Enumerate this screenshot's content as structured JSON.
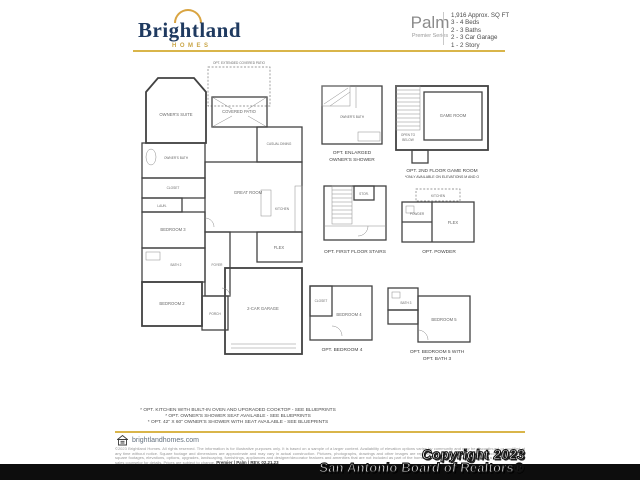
{
  "brand": {
    "name": "Brightland",
    "sub": "HOMES",
    "url": "brightlandhomes.com",
    "gold": "#D9B54A",
    "navy": "#1F3A60"
  },
  "header": {
    "plan_name": "Palm",
    "series": "Premier Series",
    "specs": [
      "1,916 Approx. SQ FT",
      "3 - 4 Beds",
      "2 - 3 Baths",
      "2 - 3 Car Garage",
      "1 - 2 Story"
    ]
  },
  "floorplan": {
    "main": {
      "ext_patio": "OPT. EXTENDED COVERED PATIO",
      "covered_patio": "COVERED PATIO",
      "owners_suite": "OWNER'S SUITE",
      "owners_bath": "OWNER'S BATH",
      "closet": "CLOSET",
      "laundry": "LAUN.",
      "casual_dining": "CASUAL DINING",
      "great_room": "GREAT ROOM",
      "kitchen": "KITCHEN",
      "bedroom3": "BEDROOM 3",
      "bath2": "BATH 2",
      "bedroom2": "BEDROOM 2",
      "foyer": "FOYER",
      "porch": "PORCH",
      "flex": "FLEX",
      "garage": "2-CAR GARAGE"
    },
    "inset_shower": {
      "room": "OWNER'S BATH",
      "caption1": "OPT. ENLARGED",
      "caption2": "OWNER'S SHOWER"
    },
    "inset_gameroom": {
      "room": "GAME ROOM",
      "open1": "OPEN TO",
      "open2": "BELOW",
      "caption1": "OPT. 2ND FLOOR GAME ROOM",
      "caption2": "*ONLY AVAILABLE ON ELEVATIONS M AND O"
    },
    "inset_stairs": {
      "stor": "STOR.",
      "caption1": "OPT. FIRST FLOOR STAIRS"
    },
    "inset_powder": {
      "kitchen": "KITCHEN",
      "flex": "FLEX",
      "powder": "POWDER",
      "caption1": "OPT. POWDER"
    },
    "inset_bed4": {
      "room": "BEDROOM 4",
      "closet": "CLOSET",
      "caption1": "OPT. BEDROOM 4"
    },
    "inset_bed5": {
      "room": "BEDROOM 5",
      "bath": "BATH 3",
      "caption1": "OPT. BEDROOM 5 WITH",
      "caption2": "OPT. BATH 3"
    }
  },
  "footnotes": [
    "* OPT. KITCHEN WITH BUILT-IN OVEN AND UPGRADED COOKTOP - SEE BLUEPRINTS",
    "* OPT. OWNER'S SHOWER SEAT AVAILABLE - SEE BLUEPRINTS",
    "* OPT. 42\" X 60\" OWNER'S SHOWER WITH SEAT AVAILABLE - SEE BLUEPRINTS"
  ],
  "disclaimer": "©2023 Brightland Homes. All rights reserved. The information is for illustrative purposes only. It is based on a sample of a larger content. Availability of elevation options varies by community and may be discontinued or modified at any time without notice. Square footage and dimensions are approximate and may vary in actual construction. Pictures, photographs, drawings and other images are representational only and may depict or contain floor plans, square footages, elevations, options, upgrades, landscaping, furnishings, appliances and designer/decorator features and amenities that are not included as part of the home or available in all communities. See a Brightland Homes sales counselor for details. Prices are subject to change.",
  "revision": "Premier | Palm | REV. 02.21.23",
  "watermark": {
    "line1": "Copyright 2023",
    "line2": "San Antonio Board of Realtors®"
  }
}
